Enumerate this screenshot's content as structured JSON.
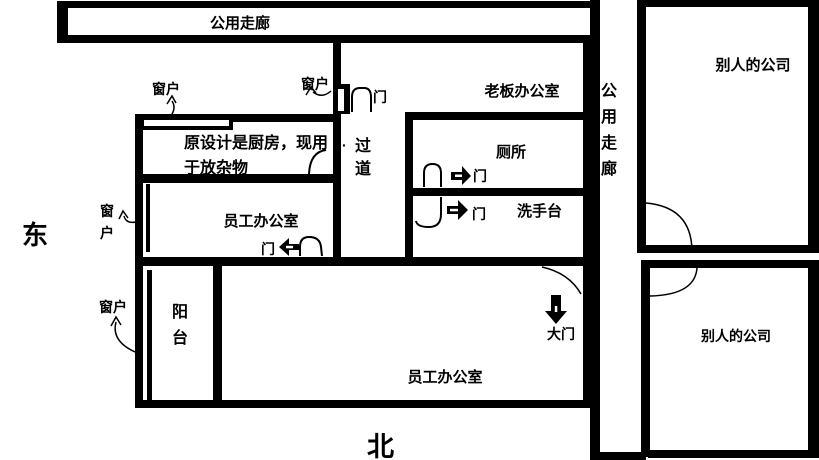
{
  "compass": {
    "east": "东",
    "north": "北"
  },
  "labels": {
    "top_corridor": "公用走廊",
    "right_corridor": "公用走廊",
    "other_company_upper": "别人的公司",
    "other_company_lower": "别人的公司",
    "boss_office": "老板办公室",
    "toilet": "厕所",
    "sink": "洗手台",
    "passage": "过道",
    "passage_dot": "·",
    "kitchen_line1": "原设计是厨房，现用",
    "kitchen_line2": "于放杂物",
    "staff_office_small": "员工办公室",
    "staff_office_large": "员工办公室",
    "balcony": "阳台",
    "main_door": "大门",
    "door_boss": "门",
    "door_toilet": "门",
    "door_sink": "门",
    "door_staff_small": "门",
    "window_kitchen": "窗户",
    "window_passage": "窗户",
    "window_staff_small": "窗户",
    "window_balcony": "窗户"
  },
  "colors": {
    "wall": "#000000",
    "background": "#ffffff"
  }
}
